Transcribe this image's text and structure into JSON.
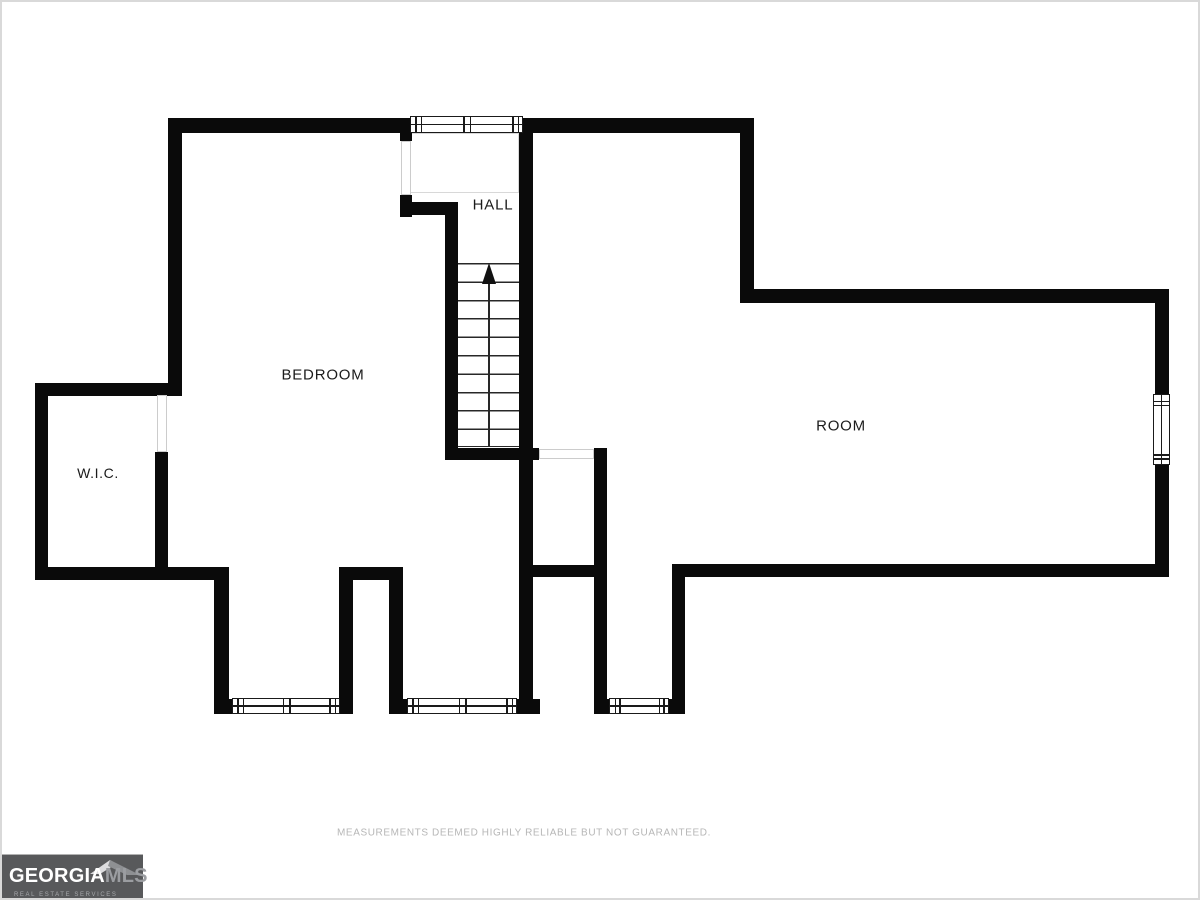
{
  "rooms": {
    "hall": {
      "label": "HALL"
    },
    "bedroom": {
      "label": "BEDROOM"
    },
    "room": {
      "label": "ROOM"
    },
    "wic": {
      "label": "W.I.C."
    }
  },
  "stairs": {
    "direction": "up",
    "treads": 10
  },
  "footer": {
    "disclaimer": "MEASUREMENTS DEEMED HIGHLY RELIABLE BUT NOT GUARANTEED."
  },
  "logo": {
    "brand": "GEORGIA",
    "brand_suffix": "MLS",
    "tagline": "REAL ESTATE SERVICES"
  },
  "colors": {
    "wall": "#0a0a0a",
    "opening_line": "#cccccc",
    "disclaimer_text": "#b6b6b6",
    "logo_background": "#58595b"
  }
}
